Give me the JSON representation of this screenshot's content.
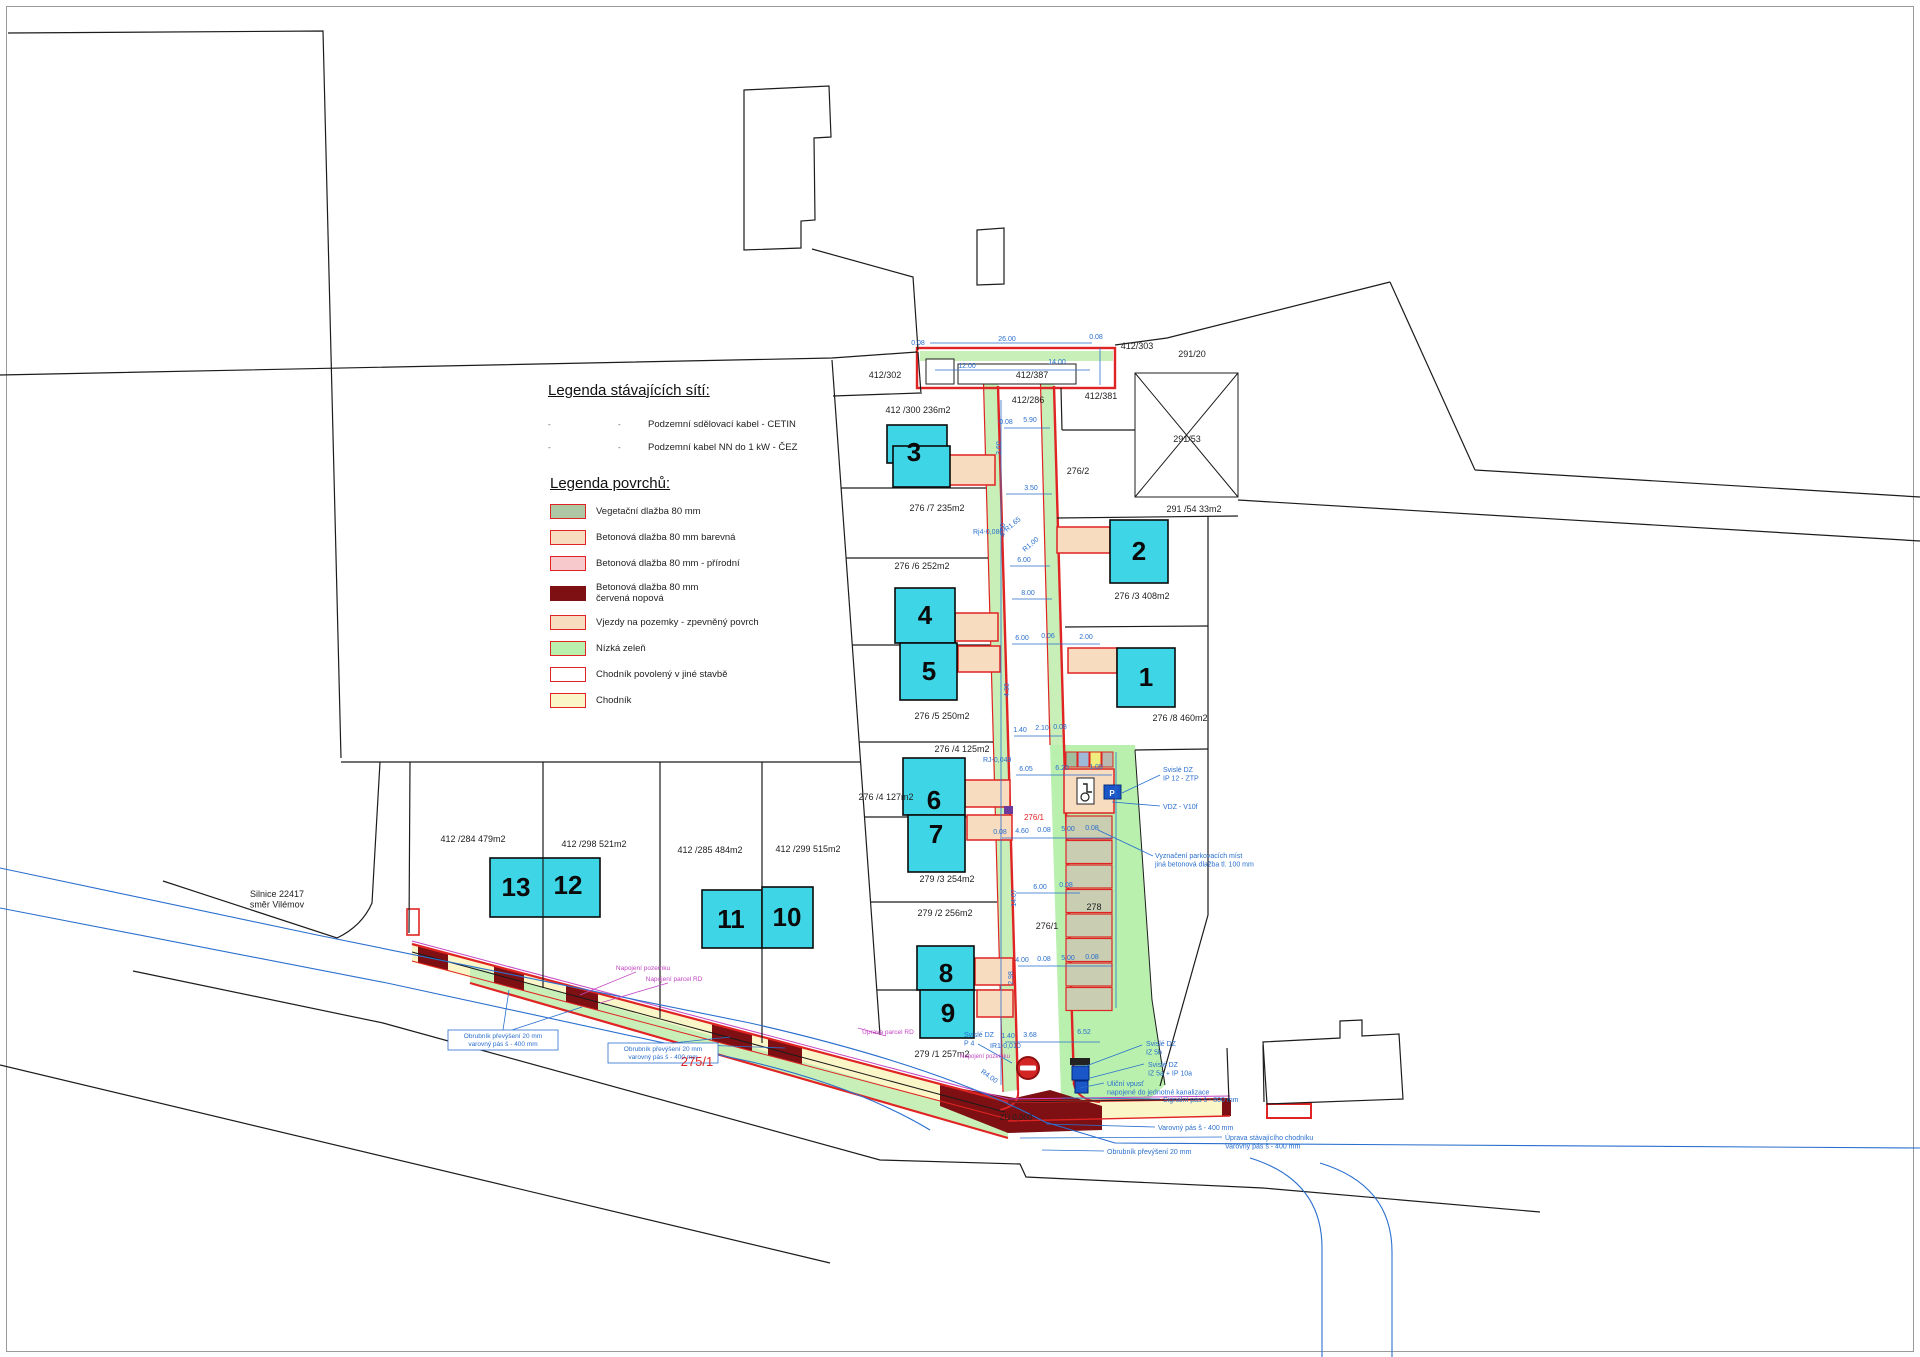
{
  "legend_networks": {
    "title": "Legenda stávajících sítí:",
    "items": [
      {
        "m1": "-",
        "m2": "-",
        "label": "Podzemní sdělovací kabel - CETIN"
      },
      {
        "m1": "-",
        "m2": "-",
        "label": "Podzemní kabel NN do 1 kW - ČEZ"
      }
    ]
  },
  "legend_surfaces": {
    "title": "Legenda povrchů:",
    "items": [
      {
        "label": "Vegetační dlažba 80 mm",
        "fill": "#aec7a4",
        "border": "#e02423"
      },
      {
        "label": "Betonová dlažba 80 mm barevná",
        "fill": "#f7dcc0",
        "border": "#e02423"
      },
      {
        "label": "Betonová dlažba 80 mm - přírodní",
        "fill": "#f7c8cc",
        "border": "#e02423"
      },
      {
        "label": "Betonová dlažba 80 mm\nčervená nopová",
        "fill": "#7e0f12",
        "border": "#7e0f12"
      },
      {
        "label": "Vjezdy na pozemky - zpevněný povrch",
        "fill": "#f7dcc0",
        "border": "#e02423"
      },
      {
        "label": "Nízká zeleň",
        "fill": "#b9f0ae",
        "border": "#e02423"
      },
      {
        "label": "Chodník povolený v jiné stavbě",
        "fill": "#ffffff",
        "border": "#e02423"
      },
      {
        "label": "Chodník",
        "fill": "#fbf6c7",
        "border": "#e02423"
      }
    ]
  },
  "colors": {
    "building": "#3ed6e6",
    "road_red": "#e02423",
    "dark_red": "#7e0f12",
    "green": "#b9f0ae",
    "yellow": "#fbf6c7",
    "peach": "#f7dcc0",
    "stall": "#c9cdb2",
    "blue": "#2a6fce",
    "magenta": "#c447c4"
  },
  "map": {
    "parking": {
      "mini_stall_colors": [
        "#9fbf9f",
        "#9fb9d9",
        "#efef7f",
        "#b9b9af"
      ],
      "stall_fill": "#c9cdb2",
      "stall_count": 8
    },
    "buildings": [
      {
        "num": "3",
        "nx": 914,
        "ny": 461,
        "rects": [
          [
            887,
            425,
            60,
            38
          ],
          [
            893,
            446,
            57,
            41
          ]
        ]
      },
      {
        "num": "2",
        "nx": 1139,
        "ny": 560,
        "rects": [
          [
            1110,
            520,
            58,
            63
          ]
        ]
      },
      {
        "num": "4",
        "nx": 925,
        "ny": 624,
        "rects": [
          [
            895,
            588,
            60,
            55
          ]
        ]
      },
      {
        "num": "5",
        "nx": 929,
        "ny": 680,
        "rects": [
          [
            900,
            643,
            57,
            57
          ]
        ]
      },
      {
        "num": "1",
        "nx": 1146,
        "ny": 686,
        "rects": [
          [
            1117,
            648,
            58,
            59
          ]
        ]
      },
      {
        "num": "6",
        "nx": 934,
        "ny": 809,
        "rects": [
          [
            903,
            758,
            62,
            57
          ]
        ]
      },
      {
        "num": "7",
        "nx": 936,
        "ny": 843,
        "rects": [
          [
            908,
            815,
            57,
            57
          ]
        ]
      },
      {
        "num": "8",
        "nx": 946,
        "ny": 982,
        "rects": [
          [
            917,
            946,
            57,
            44
          ]
        ]
      },
      {
        "num": "9",
        "nx": 948,
        "ny": 1022,
        "rects": [
          [
            920,
            990,
            54,
            48
          ]
        ]
      },
      {
        "num": "13",
        "nx": 516,
        "ny": 896,
        "rects": [
          [
            490,
            858,
            110,
            59
          ]
        ]
      },
      {
        "num": "12",
        "nx": 568,
        "ny": 894,
        "rects": []
      },
      {
        "num": "11",
        "nx": 731,
        "ny": 928,
        "rects": [
          [
            702,
            890,
            60,
            58
          ]
        ]
      },
      {
        "num": "10",
        "nx": 787,
        "ny": 926,
        "rects": [
          [
            762,
            887,
            51,
            61
          ]
        ]
      }
    ],
    "labels": [
      {
        "t": "412/302",
        "x": 885,
        "y": 378
      },
      {
        "t": "412 /300  236m2",
        "x": 918,
        "y": 413
      },
      {
        "t": "412/286",
        "x": 1028,
        "y": 403
      },
      {
        "t": "412/387",
        "x": 1032,
        "y": 378
      },
      {
        "t": "412/303",
        "x": 1137,
        "y": 349
      },
      {
        "t": "412/381",
        "x": 1101,
        "y": 399
      },
      {
        "t": "291/20",
        "x": 1192,
        "y": 357
      },
      {
        "t": "291/53",
        "x": 1187,
        "y": 442
      },
      {
        "t": "291 /54  33m2",
        "x": 1194,
        "y": 512
      },
      {
        "t": "276/2",
        "x": 1078,
        "y": 474
      },
      {
        "t": "276 /7  235m2",
        "x": 937,
        "y": 511
      },
      {
        "t": "276 /6  252m2",
        "x": 922,
        "y": 569
      },
      {
        "t": "276 /3   408m2",
        "x": 1142,
        "y": 599
      },
      {
        "t": "276 /5  250m2",
        "x": 942,
        "y": 719
      },
      {
        "t": "276 /8   460m2",
        "x": 1180,
        "y": 721
      },
      {
        "t": "276 /4  125m2",
        "x": 962,
        "y": 752
      },
      {
        "t": "276 /4  127m2",
        "x": 886,
        "y": 800
      },
      {
        "t": "279 /3  254m2",
        "x": 947,
        "y": 882
      },
      {
        "t": "279 /2  256m2",
        "x": 945,
        "y": 916
      },
      {
        "t": "279 /1  257m2",
        "x": 942,
        "y": 1057
      },
      {
        "t": "278",
        "x": 1094,
        "y": 910
      },
      {
        "t": "276/1",
        "x": 1047,
        "y": 929
      },
      {
        "t": "412 /284   479m2",
        "x": 473,
        "y": 842
      },
      {
        "t": "412 /298   521m2",
        "x": 594,
        "y": 847
      },
      {
        "t": "412 /285   484m2",
        "x": 710,
        "y": 853
      },
      {
        "t": "412 /299  515m2",
        "x": 808,
        "y": 852
      },
      {
        "t": "Silnice 22417\nsměr Vilémov",
        "x": 277,
        "y": 897
      },
      {
        "t": "ZÚ 0,000",
        "x": 1016,
        "y": 1120,
        "s": 8
      },
      {
        "t": "275/1",
        "x": 697,
        "y": 1066,
        "s": 13,
        "c": "r"
      },
      {
        "t": "276/1",
        "x": 1034,
        "y": 820,
        "s": 8,
        "c": "r"
      },
      {
        "t": "Svislé DZ\nIP 12 - ZTP",
        "x": 1163,
        "y": 772,
        "s": 7,
        "c": "b",
        "a": "s"
      },
      {
        "t": "VDZ - V10f",
        "x": 1163,
        "y": 809,
        "s": 7,
        "c": "b",
        "a": "s"
      },
      {
        "t": "Vyznačení parkovacích míst\njiná betonová dlažba tl. 100 mm",
        "x": 1155,
        "y": 858,
        "s": 7,
        "c": "b",
        "a": "s"
      },
      {
        "t": "Svislé DZ\nIZ 5b",
        "x": 1146,
        "y": 1046,
        "s": 7,
        "c": "b",
        "a": "s"
      },
      {
        "t": "Svislé DZ\nIZ 5a + IP 10a",
        "x": 1148,
        "y": 1067,
        "s": 7,
        "c": "b",
        "a": "s"
      },
      {
        "t": "Uliční vpusť\nnapojené do jednotné kanalizace",
        "x": 1107,
        "y": 1086,
        "s": 7,
        "c": "b",
        "a": "s"
      },
      {
        "t": "Signální pás š - 800 mm",
        "x": 1163,
        "y": 1102,
        "s": 7,
        "c": "b",
        "a": "s"
      },
      {
        "t": "Varovný pás š - 400 mm",
        "x": 1158,
        "y": 1130,
        "s": 7,
        "c": "b",
        "a": "s"
      },
      {
        "t": "Úprava stávajícího chodníku\nVarovný pás š - 400 mm",
        "x": 1225,
        "y": 1140,
        "s": 7,
        "c": "b",
        "a": "s"
      },
      {
        "t": "Obrubník převýšení 20 mm",
        "x": 1107,
        "y": 1154,
        "s": 7,
        "c": "b",
        "a": "s"
      },
      {
        "t": "Svislé DZ\nP 4",
        "x": 964,
        "y": 1037,
        "s": 7,
        "c": "b",
        "a": "s"
      },
      {
        "t": "IR1-0,010",
        "x": 990,
        "y": 1048,
        "s": 7,
        "c": "b",
        "a": "s"
      },
      {
        "t": "RJ-0,049",
        "x": 983,
        "y": 762,
        "s": 7,
        "c": "b",
        "a": "s"
      },
      {
        "t": "Rj4-0,080",
        "x": 973,
        "y": 534,
        "s": 7,
        "c": "b",
        "a": "s"
      },
      {
        "t": "Obrubník převýšení 20 mm\nvarovný pás š - 400 mm",
        "x": 503,
        "y": 1038,
        "s": 6.5,
        "c": "b"
      },
      {
        "t": "Obrubník převýšení 20 mm\nvarovný pás š - 400 mm",
        "x": 663,
        "y": 1051,
        "s": 6.5,
        "c": "b"
      },
      {
        "t": "0.08",
        "x": 918,
        "y": 345,
        "s": 7,
        "c": "b"
      },
      {
        "t": "26.00",
        "x": 1007,
        "y": 341,
        "s": 7,
        "c": "b"
      },
      {
        "t": "0.08",
        "x": 1096,
        "y": 339,
        "s": 7,
        "c": "b"
      },
      {
        "t": "12.00",
        "x": 967,
        "y": 368,
        "s": 7,
        "c": "b"
      },
      {
        "t": "14.00",
        "x": 1057,
        "y": 364,
        "s": 7,
        "c": "b"
      },
      {
        "t": "0.08",
        "x": 1006,
        "y": 424,
        "s": 7,
        "c": "b"
      },
      {
        "t": "5.90",
        "x": 1030,
        "y": 422,
        "s": 7,
        "c": "b"
      },
      {
        "t": "3.50",
        "x": 1031,
        "y": 490,
        "s": 7,
        "c": "b"
      },
      {
        "t": "6.00",
        "x": 1024,
        "y": 562,
        "s": 7,
        "c": "b"
      },
      {
        "t": "8.00",
        "x": 1028,
        "y": 595,
        "s": 7,
        "c": "b"
      },
      {
        "t": "6.00",
        "x": 1022,
        "y": 640,
        "s": 7,
        "c": "b"
      },
      {
        "t": "0.06",
        "x": 1048,
        "y": 638,
        "s": 7,
        "c": "b"
      },
      {
        "t": "2.00",
        "x": 1086,
        "y": 639,
        "s": 7,
        "c": "b"
      },
      {
        "t": "1.40",
        "x": 1020,
        "y": 732,
        "s": 7,
        "c": "b"
      },
      {
        "t": "2.10",
        "x": 1042,
        "y": 730,
        "s": 7,
        "c": "b"
      },
      {
        "t": "0.08",
        "x": 1060,
        "y": 729,
        "s": 7,
        "c": "b"
      },
      {
        "t": "6.05",
        "x": 1026,
        "y": 771,
        "s": 7,
        "c": "b"
      },
      {
        "t": "6.20",
        "x": 1062,
        "y": 770,
        "s": 7,
        "c": "b"
      },
      {
        "t": "1.05",
        "x": 1096,
        "y": 769,
        "s": 7,
        "c": "b"
      },
      {
        "t": "0.08",
        "x": 1000,
        "y": 834,
        "s": 7,
        "c": "b"
      },
      {
        "t": "4.60",
        "x": 1022,
        "y": 833,
        "s": 7,
        "c": "b"
      },
      {
        "t": "0.08",
        "x": 1044,
        "y": 832,
        "s": 7,
        "c": "b"
      },
      {
        "t": "5.00",
        "x": 1068,
        "y": 831,
        "s": 7,
        "c": "b"
      },
      {
        "t": "0.08",
        "x": 1092,
        "y": 830,
        "s": 7,
        "c": "b"
      },
      {
        "t": "6.00",
        "x": 1040,
        "y": 889,
        "s": 7,
        "c": "b"
      },
      {
        "t": "0.08",
        "x": 1066,
        "y": 887,
        "s": 7,
        "c": "b"
      },
      {
        "t": "4.00",
        "x": 1022,
        "y": 962,
        "s": 7,
        "c": "b"
      },
      {
        "t": "0.08",
        "x": 1044,
        "y": 961,
        "s": 7,
        "c": "b"
      },
      {
        "t": "5.00",
        "x": 1068,
        "y": 960,
        "s": 7,
        "c": "b"
      },
      {
        "t": "0.08",
        "x": 1092,
        "y": 959,
        "s": 7,
        "c": "b"
      },
      {
        "t": "1.40",
        "x": 1008,
        "y": 1038,
        "s": 7,
        "c": "b"
      },
      {
        "t": "3.68",
        "x": 1030,
        "y": 1037,
        "s": 7,
        "c": "b"
      },
      {
        "t": "6.52",
        "x": 1084,
        "y": 1034,
        "s": 7,
        "c": "b"
      },
      {
        "t": "3.60",
        "x": 1001,
        "y": 448,
        "s": 7,
        "c": "b",
        "r": -90
      },
      {
        "t": "4.50",
        "x": 1005,
        "y": 530,
        "s": 7,
        "c": "b",
        "r": -90
      },
      {
        "t": "4.30",
        "x": 1009,
        "y": 690,
        "s": 7,
        "c": "b",
        "r": -90
      },
      {
        "t": "14.07",
        "x": 1016,
        "y": 898,
        "s": 7,
        "c": "b",
        "r": -90
      },
      {
        "t": "2.98",
        "x": 1013,
        "y": 978,
        "s": 7,
        "c": "b",
        "r": -90
      },
      {
        "t": "R1.65",
        "x": 1014,
        "y": 526,
        "s": 7,
        "c": "b",
        "r": -40
      },
      {
        "t": "R1.00",
        "x": 1032,
        "y": 546,
        "s": 7,
        "c": "b",
        "r": -40
      },
      {
        "t": "R4.00",
        "x": 988,
        "y": 1078,
        "s": 7,
        "c": "b",
        "r": 35
      },
      {
        "t": "Napojení pozemku",
        "x": 643,
        "y": 970,
        "s": 6.5,
        "c": "m"
      },
      {
        "t": "Napojení parcel RD",
        "x": 674,
        "y": 981,
        "s": 6.5,
        "c": "m"
      },
      {
        "t": "Úprava parcel RD",
        "x": 888,
        "y": 1034,
        "s": 6.5,
        "c": "m"
      },
      {
        "t": "Napojení pozemku",
        "x": 985,
        "y": 1058,
        "s": 6,
        "c": "m"
      },
      {
        "t": "P",
        "x": 1112,
        "y": 796,
        "s": 8,
        "c": "w"
      }
    ]
  }
}
